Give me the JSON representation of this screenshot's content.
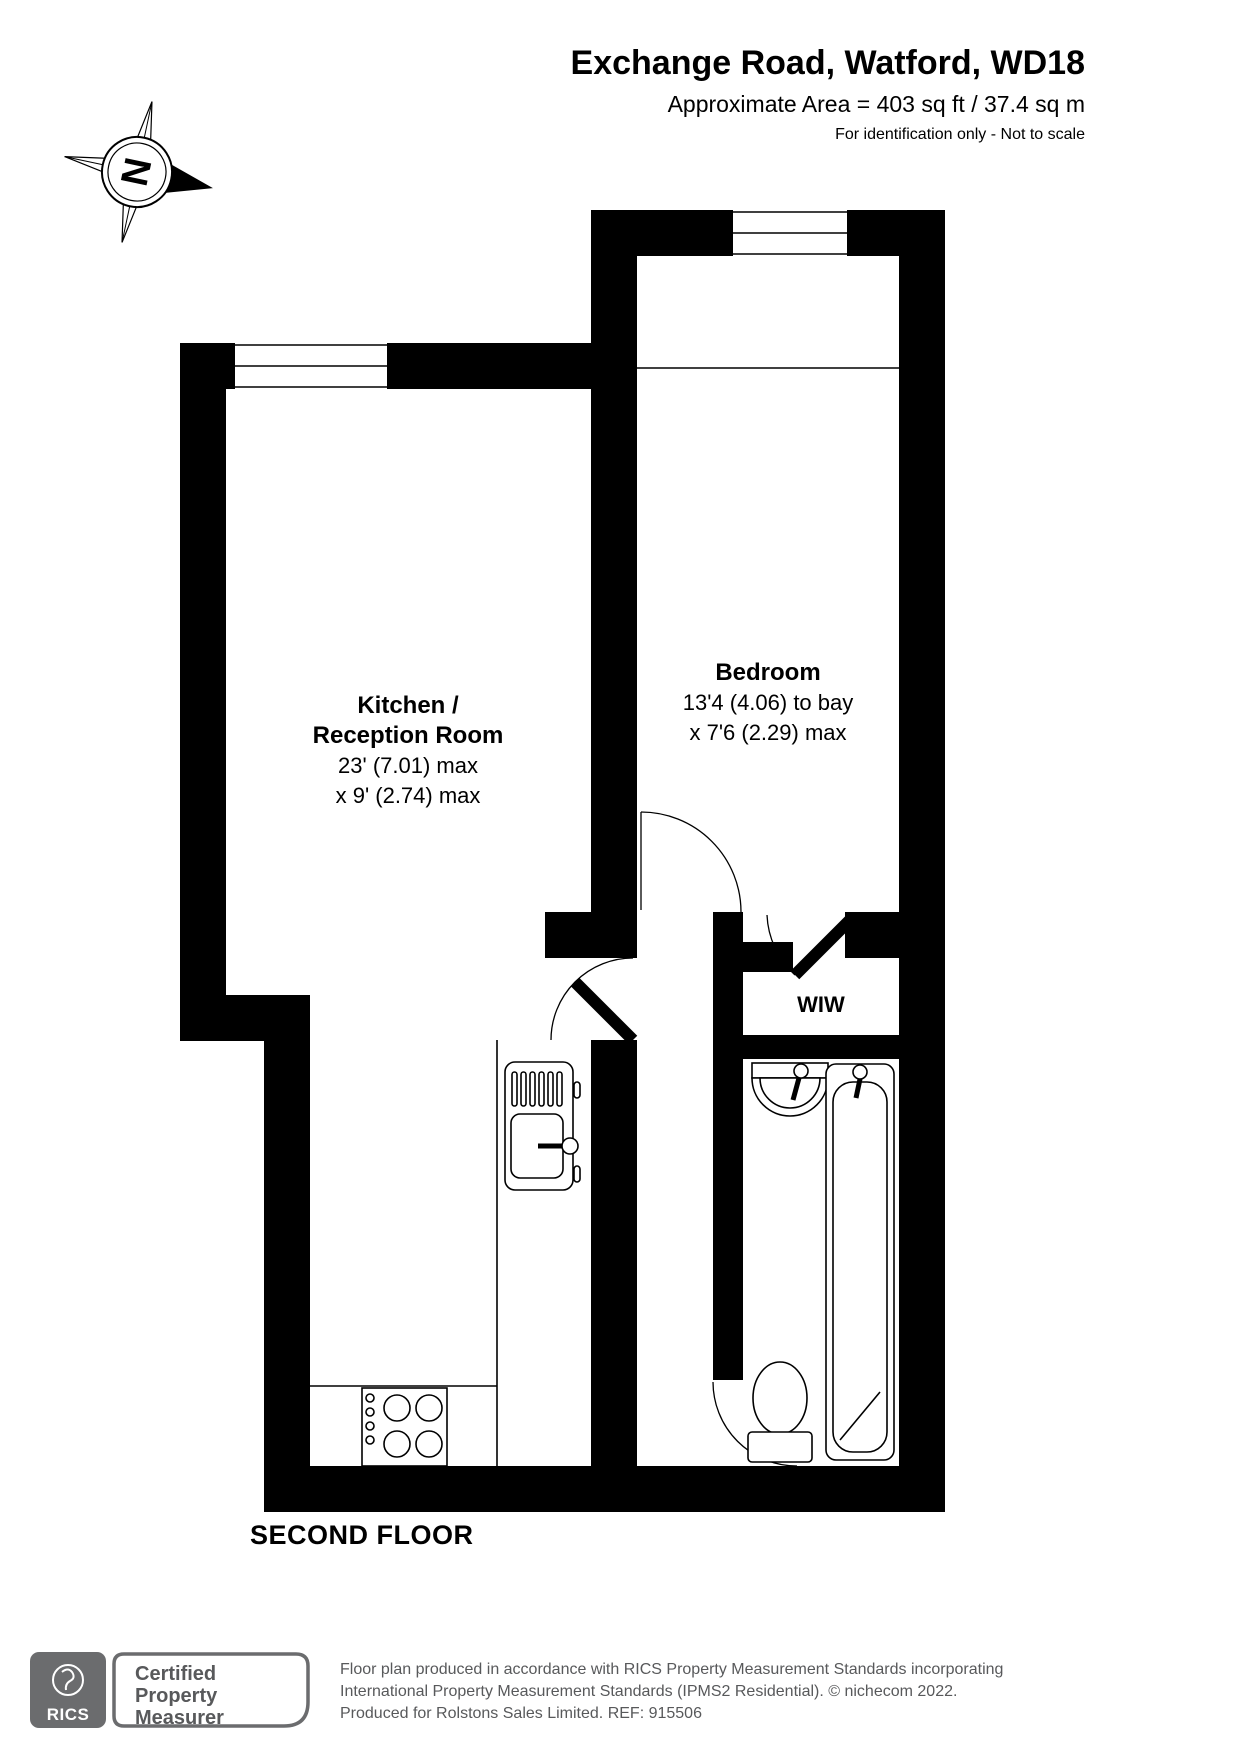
{
  "header": {
    "title": "Exchange Road, Watford, WD18",
    "area": "Approximate Area = 403 sq ft / 37.4 sq m",
    "note": "For identification only - Not to scale"
  },
  "compass": {
    "north_label": "N"
  },
  "rooms": {
    "kitchen": {
      "name_line1": "Kitchen /",
      "name_line2": "Reception Room",
      "dim_line1": "23' (7.01) max",
      "dim_line2": "x 9' (2.74) max"
    },
    "bedroom": {
      "name": "Bedroom",
      "dim_line1": "13'4 (4.06) to bay",
      "dim_line2": "x 7'6 (2.29) max"
    },
    "wiw": {
      "name": "WIW"
    }
  },
  "floor_label": "SECOND FLOOR",
  "footer": {
    "rics_logo": "RICS",
    "badge": [
      "Certified",
      "Property",
      "Measurer"
    ],
    "disclaimer": [
      "Floor plan produced in accordance with RICS Property Measurement Standards incorporating",
      "International Property Measurement Standards (IPMS2 Residential).   © nichecom 2022.",
      "Produced for Rolstons Sales Limited.   REF:  915506"
    ]
  },
  "colors": {
    "wall": "#000000",
    "footer_grey": "#58595b",
    "logo_grey": "#6b6c6e"
  }
}
